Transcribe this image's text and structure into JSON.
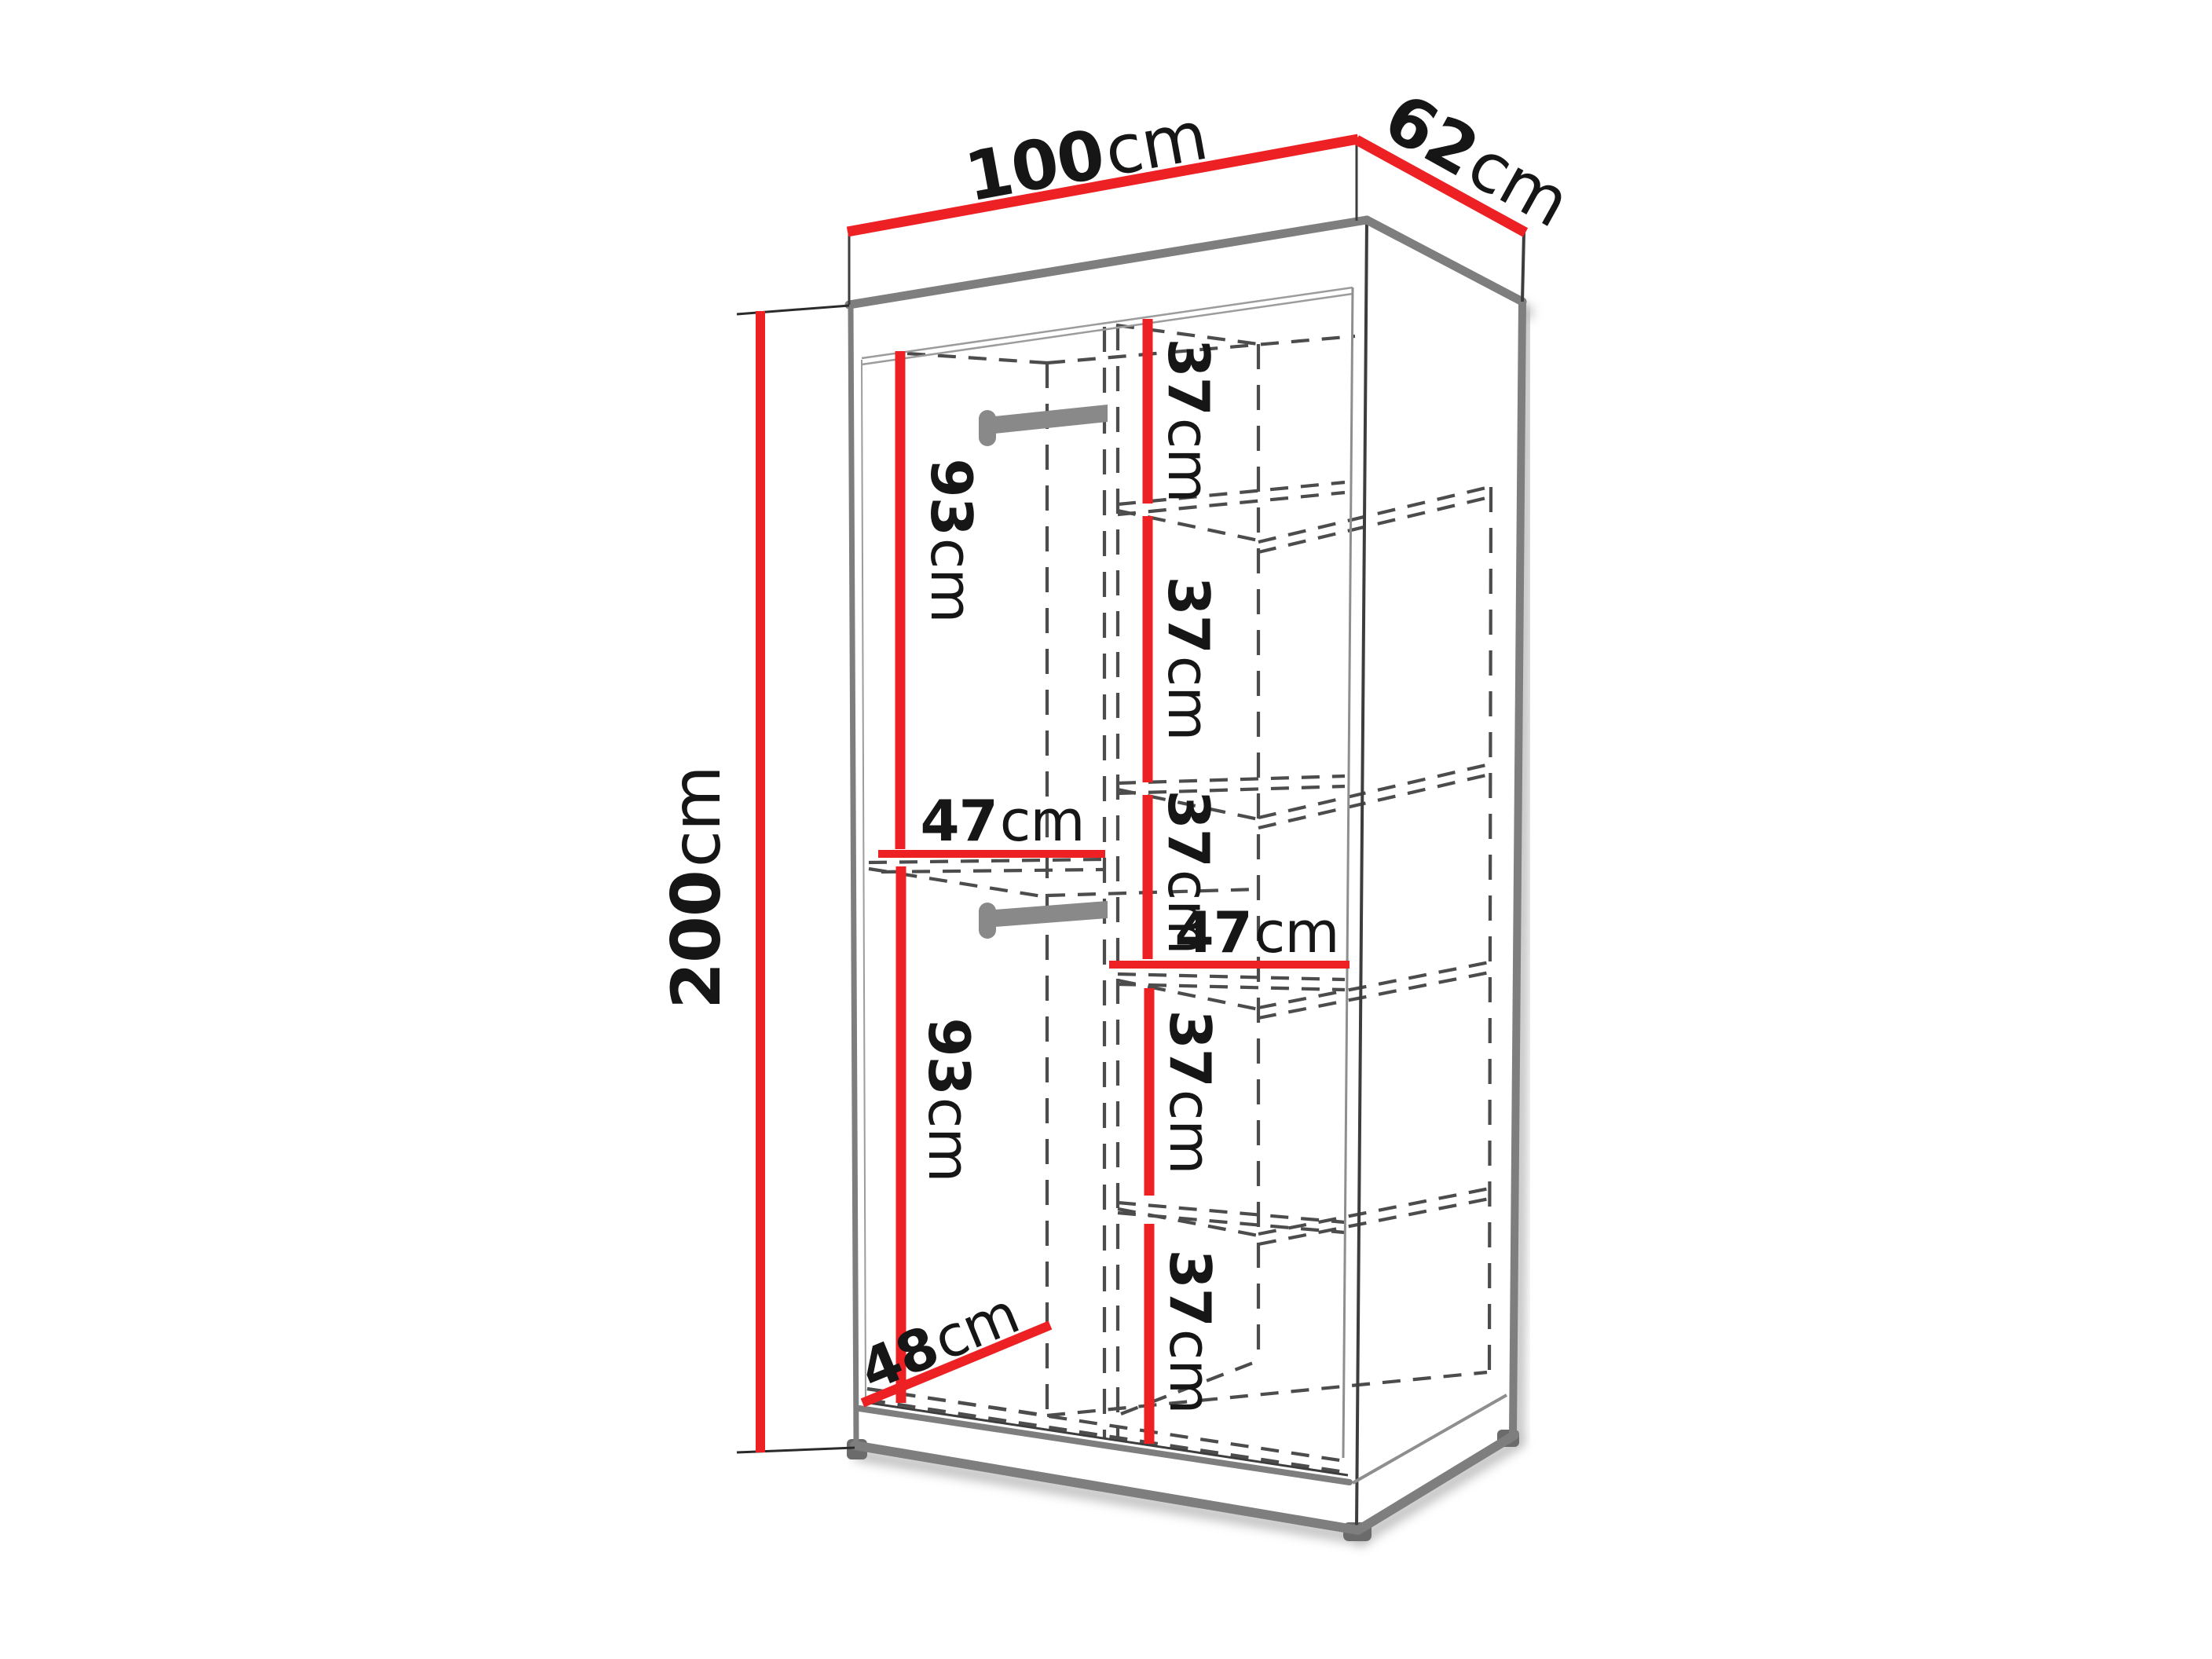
{
  "diagram": {
    "kind": "wardrobe-dimension-diagram",
    "colors": {
      "dimension_line": "#ed2024",
      "cabinet_edge": "#7e7e7e",
      "hidden_edge": "#4c4c4c",
      "rod": "#898989",
      "label_text": "#161616",
      "background": "#ffffff"
    }
  },
  "dims": {
    "width": {
      "value": "100",
      "unit": "cm"
    },
    "depth": {
      "value": "62",
      "unit": "cm"
    },
    "height": {
      "value": "200",
      "unit": "cm"
    },
    "upper_hanging": {
      "value": "93",
      "unit": "cm"
    },
    "lower_hanging": {
      "value": "93",
      "unit": "cm"
    },
    "left_shelf_width": {
      "value": "47",
      "unit": "cm"
    },
    "right_shelf_width": {
      "value": "47",
      "unit": "cm"
    },
    "interior_depth": {
      "value": "48",
      "unit": "cm"
    },
    "shelf_spacings": [
      {
        "value": "37",
        "unit": "cm"
      },
      {
        "value": "37",
        "unit": "cm"
      },
      {
        "value": "37",
        "unit": "cm"
      },
      {
        "value": "37",
        "unit": "cm"
      },
      {
        "value": "37",
        "unit": "cm"
      }
    ]
  }
}
